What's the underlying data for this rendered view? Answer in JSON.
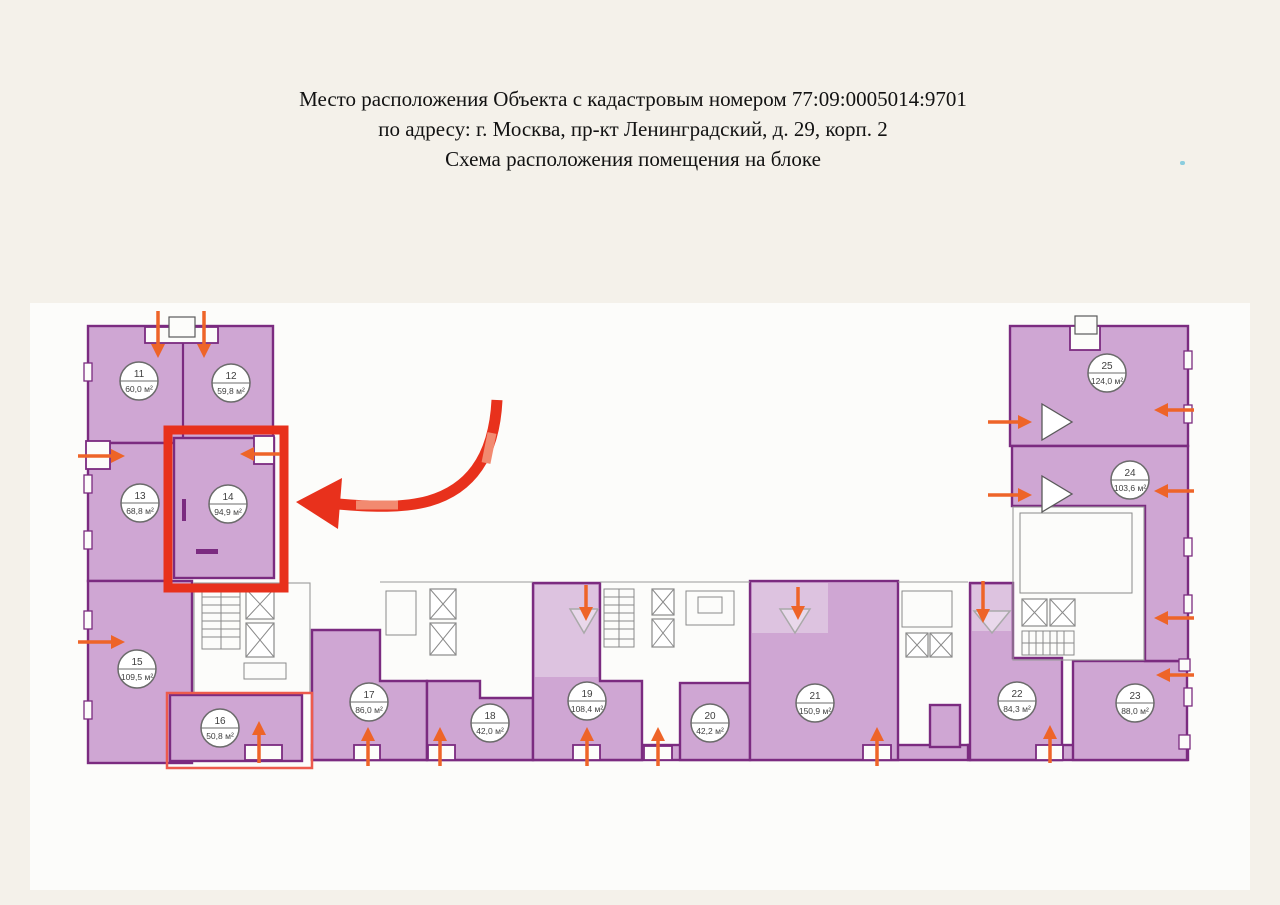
{
  "header": {
    "line1": "Место расположения Объекта с кадастровым номером 77:09:0005014:9701",
    "line2": "по адресу: г. Москва, пр-кт Ленинградский, д. 29, корп. 2",
    "line3": "Схема расположения помещения на блоке"
  },
  "cadastral_number": "77:09:0005014:9701",
  "plan": {
    "rooms": [
      {
        "number": "11",
        "area": "60,0 м²",
        "highlighted": false
      },
      {
        "number": "12",
        "area": "59,8 м²",
        "highlighted": false
      },
      {
        "number": "13",
        "area": "68,8 м²",
        "highlighted": false
      },
      {
        "number": "14",
        "area": "94,9 м²",
        "highlighted": true
      },
      {
        "number": "15",
        "area": "109,5 м²",
        "highlighted": false
      },
      {
        "number": "16",
        "area": "50,8 м²",
        "highlighted": true
      },
      {
        "number": "17",
        "area": "86,0 м²",
        "highlighted": false
      },
      {
        "number": "18",
        "area": "42,0 м²",
        "highlighted": false
      },
      {
        "number": "19",
        "area": "108,4 м²",
        "highlighted": false
      },
      {
        "number": "20",
        "area": "42,2 м²",
        "highlighted": false
      },
      {
        "number": "21",
        "area": "150,9 м²",
        "highlighted": false
      },
      {
        "number": "22",
        "area": "84,3 м²",
        "highlighted": false
      },
      {
        "number": "23",
        "area": "88,0 м²",
        "highlighted": false
      },
      {
        "number": "24",
        "area": "103,6 м²",
        "highlighted": false
      },
      {
        "number": "25",
        "area": "124,0 м²",
        "highlighted": false
      }
    ],
    "highlight": {
      "primary_room": "14",
      "secondary_room": "16"
    }
  },
  "colors": {
    "page_background": "#f4f1ea",
    "sheet_background": "#fcfcfa",
    "room_fill": "#cfa6d3",
    "room_fill_light": "#ddc3e0",
    "wall": "#7b2b80",
    "highlight_red": "#e8311c",
    "secondary_red": "#ed5b4d",
    "arrow_orange": "#ee6428"
  }
}
